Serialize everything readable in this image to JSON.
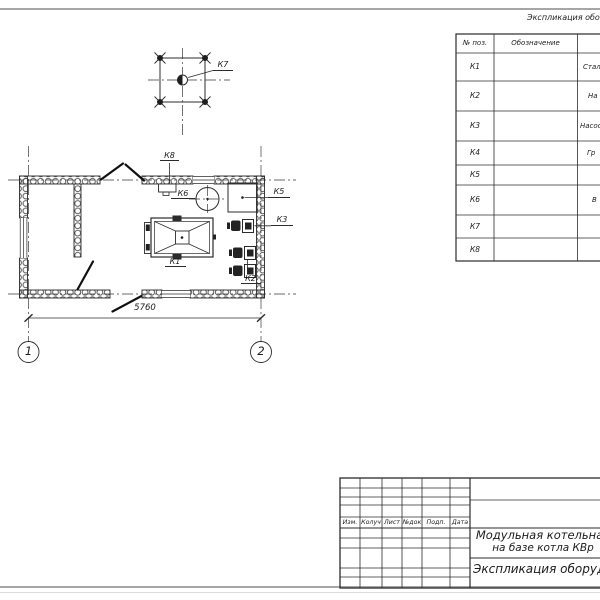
{
  "equipment_table": {
    "title": "Экспликация обору",
    "headers": {
      "pos": "№ поз.",
      "designation": "Обозначение"
    },
    "rows": [
      {
        "pos": "К1",
        "designation": "",
        "name": "Стал"
      },
      {
        "pos": "К2",
        "designation": "",
        "name": "На"
      },
      {
        "pos": "К3",
        "designation": "",
        "name": "Насос"
      },
      {
        "pos": "К4",
        "designation": "",
        "name": "Гр"
      },
      {
        "pos": "К5",
        "designation": "",
        "name": ""
      },
      {
        "pos": "К6",
        "designation": "",
        "name": "В"
      },
      {
        "pos": "К7",
        "designation": "",
        "name": ""
      },
      {
        "pos": "К8",
        "designation": "",
        "name": ""
      }
    ]
  },
  "plan": {
    "labels": {
      "k1": "К1",
      "k2": "К2",
      "k3": "К3",
      "k5": "К5",
      "k6": "К6",
      "k7": "К7",
      "k8": "К8"
    },
    "dimension": "5760",
    "axes": {
      "a1": "1",
      "a2": "2"
    }
  },
  "title_block": {
    "columns": {
      "izm": "Изм.",
      "kol": "Колуч",
      "list": "Лист",
      "ndok": "№док",
      "podp": "Подп.",
      "data": "Дата"
    },
    "project_line1": "Модульная котельная",
    "project_line2": "на базе котла КВр",
    "doc_name": "Экспликация оборудован"
  },
  "colors": {
    "line": "#2b2b2b",
    "edge": "#a6a6a6"
  }
}
